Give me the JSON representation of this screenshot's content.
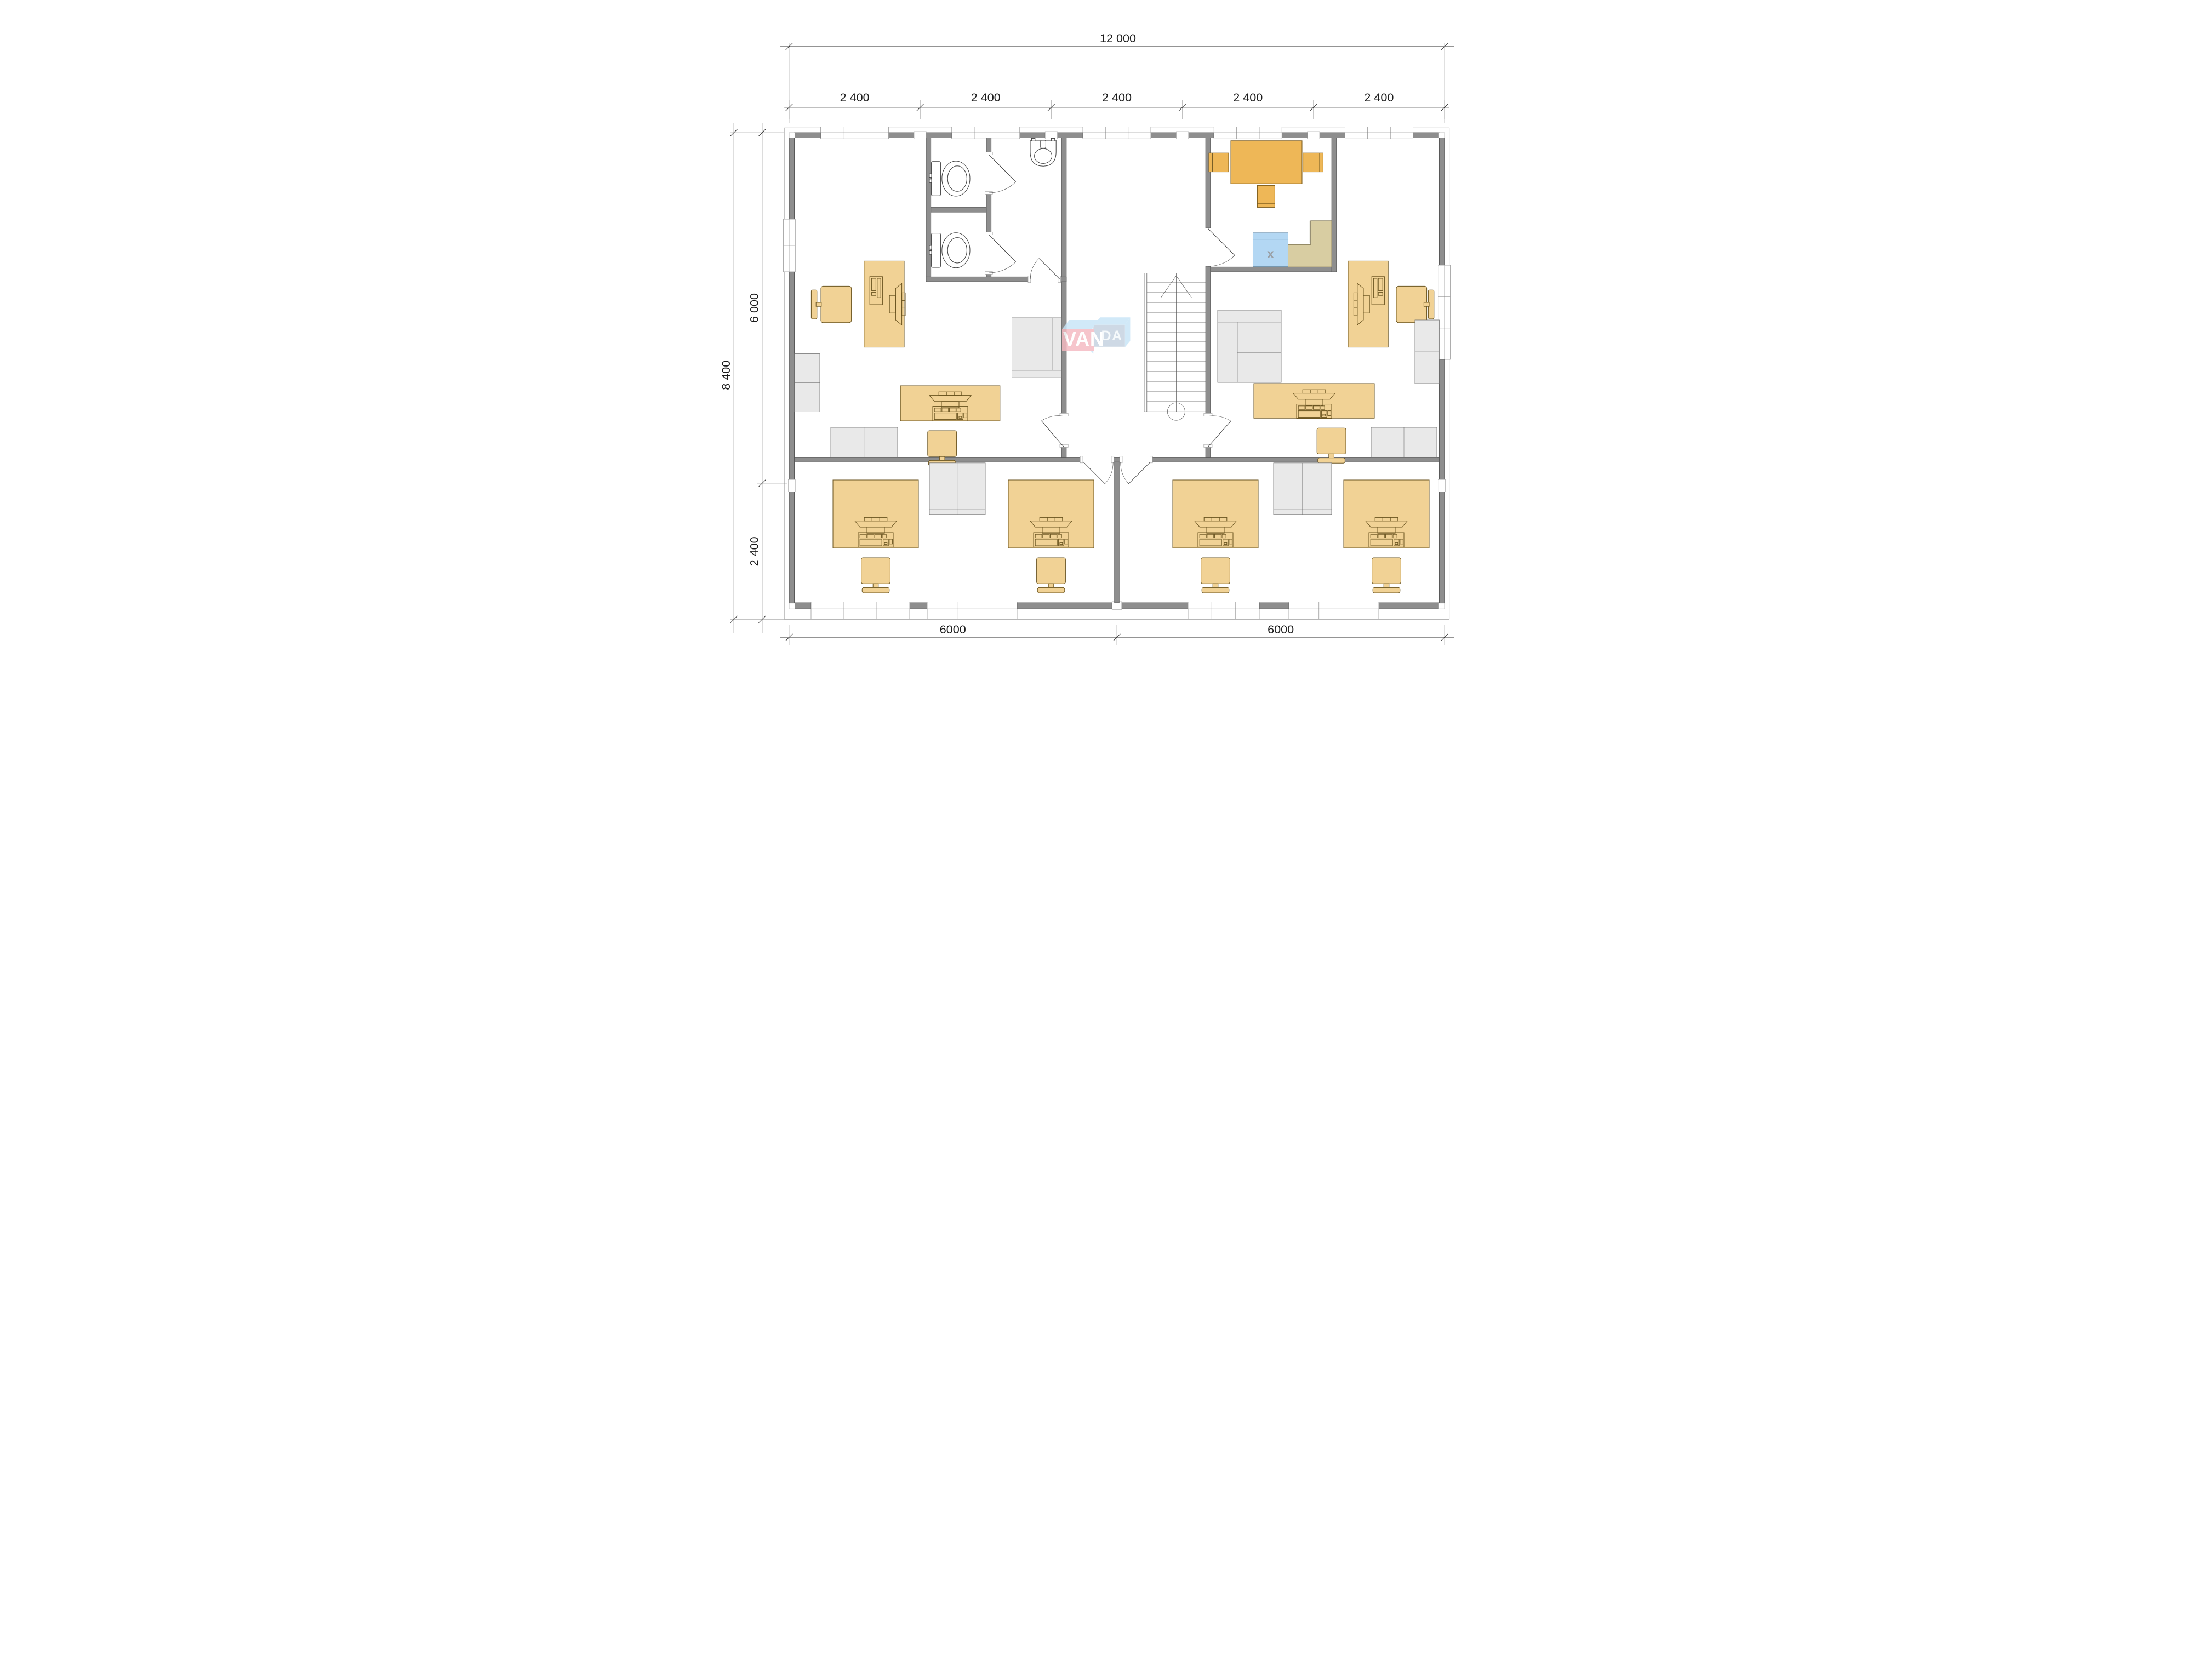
{
  "plan": {
    "title": "office-floor-plan",
    "logo": {
      "van": "VAN",
      "da": "DA"
    },
    "labels": {
      "appliance_x": "x"
    },
    "dimensions": {
      "top_total": "12 000",
      "top_segments": [
        "2 400",
        "2 400",
        "2 400",
        "2 400",
        "2 400"
      ],
      "side_total": "8 400",
      "side_upper": "6 000",
      "side_lower": "2 400",
      "bottom_segments": [
        "6000",
        "6000"
      ]
    },
    "rooms": [
      "office-left",
      "wc-block",
      "hall-stairs",
      "meeting-room",
      "office-right",
      "office-bottom-left",
      "office-bottom-right"
    ],
    "colors": {
      "wall": "#8e8e8e",
      "wall_line": "#4a4a4a",
      "desk": "#f1d295",
      "desk_line": "#6a5420",
      "table": "#eeb757",
      "cabinet": "#e9e9e9",
      "cabinet_line": "#6f6f6f",
      "appliance": "#b3d7f3",
      "appliance_line": "#5d87a6",
      "counter": "#d8cda2",
      "counter_line": "#7e7452",
      "fixture_line": "#3f3f3f",
      "dim": "#1c1c1c",
      "dim_line": "#555555",
      "logo_pink": "#f5b9c1",
      "logo_front_blue": "#c4d1e0",
      "logo_light_blue": "#c8e5f7",
      "logo_text": "#ffffff",
      "x_label": "#9aa0a6"
    }
  }
}
